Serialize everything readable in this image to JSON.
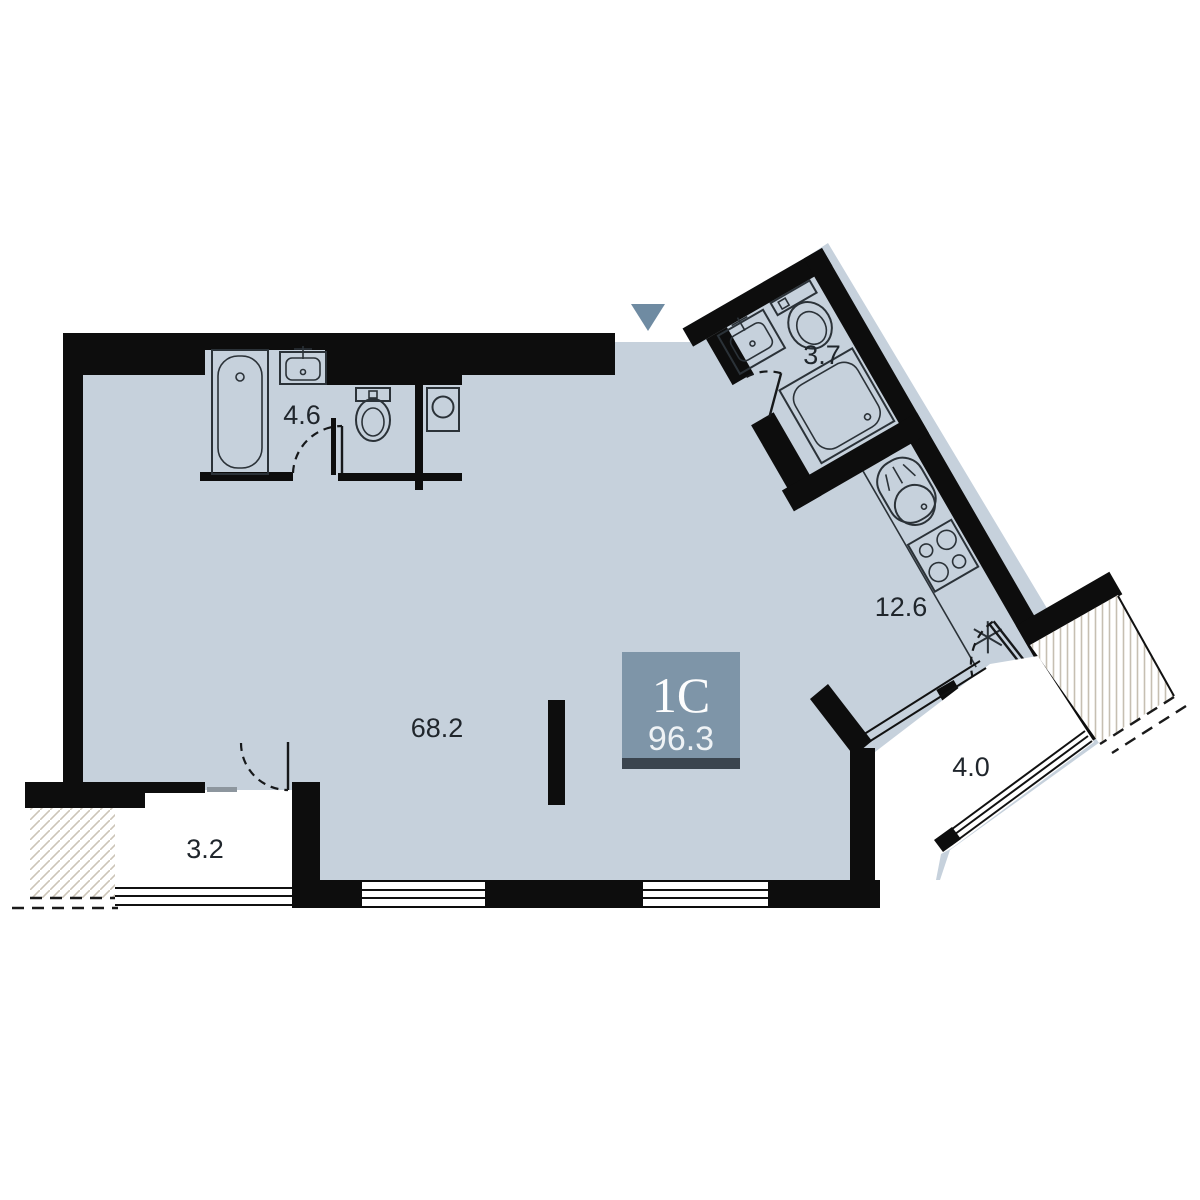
{
  "plan": {
    "unit": {
      "type_label": "1С",
      "total_area": "96.3"
    },
    "rooms": {
      "living": {
        "name": "living-room",
        "area": "68.2"
      },
      "kitchen": {
        "name": "kitchen",
        "area": "12.6"
      },
      "bathroom_main": {
        "name": "bathroom",
        "area": "4.6"
      },
      "bathroom_second": {
        "name": "shower-room",
        "area": "3.7"
      },
      "loggia_left": {
        "name": "loggia",
        "area": "3.2"
      },
      "balcony_right": {
        "name": "balcony",
        "area": "4.0"
      }
    },
    "fixtures": [
      "bathtub",
      "washbasin",
      "toilet",
      "washing-machine",
      "washbasin-2",
      "toilet-2",
      "shower-cabin",
      "kitchen-sink",
      "stove",
      "ventilation-mark",
      "entrance-arrow"
    ],
    "colors": {
      "floor": "#c6d1dc",
      "wall": "#0d0d0d",
      "unit_box": "#7e95a8",
      "unit_bar": "#3a444e",
      "entrance_marker": "#6f8ba2"
    }
  }
}
